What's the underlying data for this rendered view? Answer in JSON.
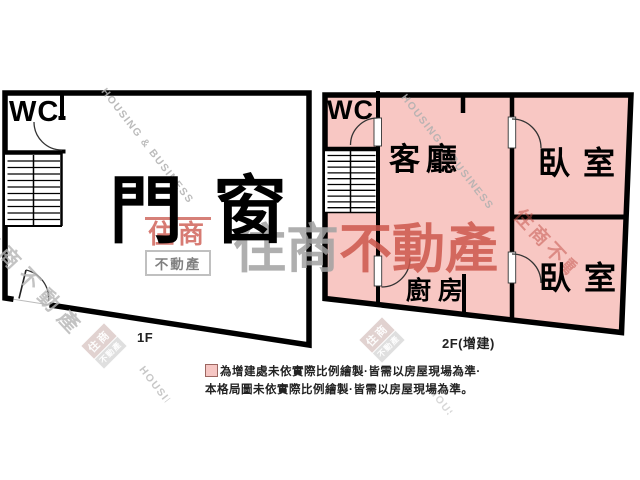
{
  "floor1": {
    "label": "1F",
    "rooms": {
      "wc": "WC",
      "main": "門窗"
    }
  },
  "floor2": {
    "label": "2F(增建)",
    "rooms": {
      "wc": "WC",
      "living": "客廳",
      "bedroom_top": "臥室",
      "bedroom_bottom": "臥室",
      "kitchen": "廚房"
    }
  },
  "legend": {
    "line1": "為增建處未依實際比例繪製·皆需以房屋現場為準·",
    "line2": "本格局圖未依實際比例繪製·皆需以房屋現場為準。"
  },
  "watermarks": {
    "brand_en": "HOUSING & BUSINESS",
    "brand_zh": "住商不動產",
    "brand_zh_gray": "住商",
    "brand_zh_red": "不動產",
    "logo_top": "住商",
    "logo_bottom": "不動產"
  },
  "colors": {
    "annex_fill": "#f8c7c3",
    "wall": "#000000",
    "watermark_red": "#cd584d",
    "watermark_gray": "#a2a2a2",
    "legend_swatch_fill": "#f6c6c3",
    "legend_swatch_border": "#9c6660"
  }
}
